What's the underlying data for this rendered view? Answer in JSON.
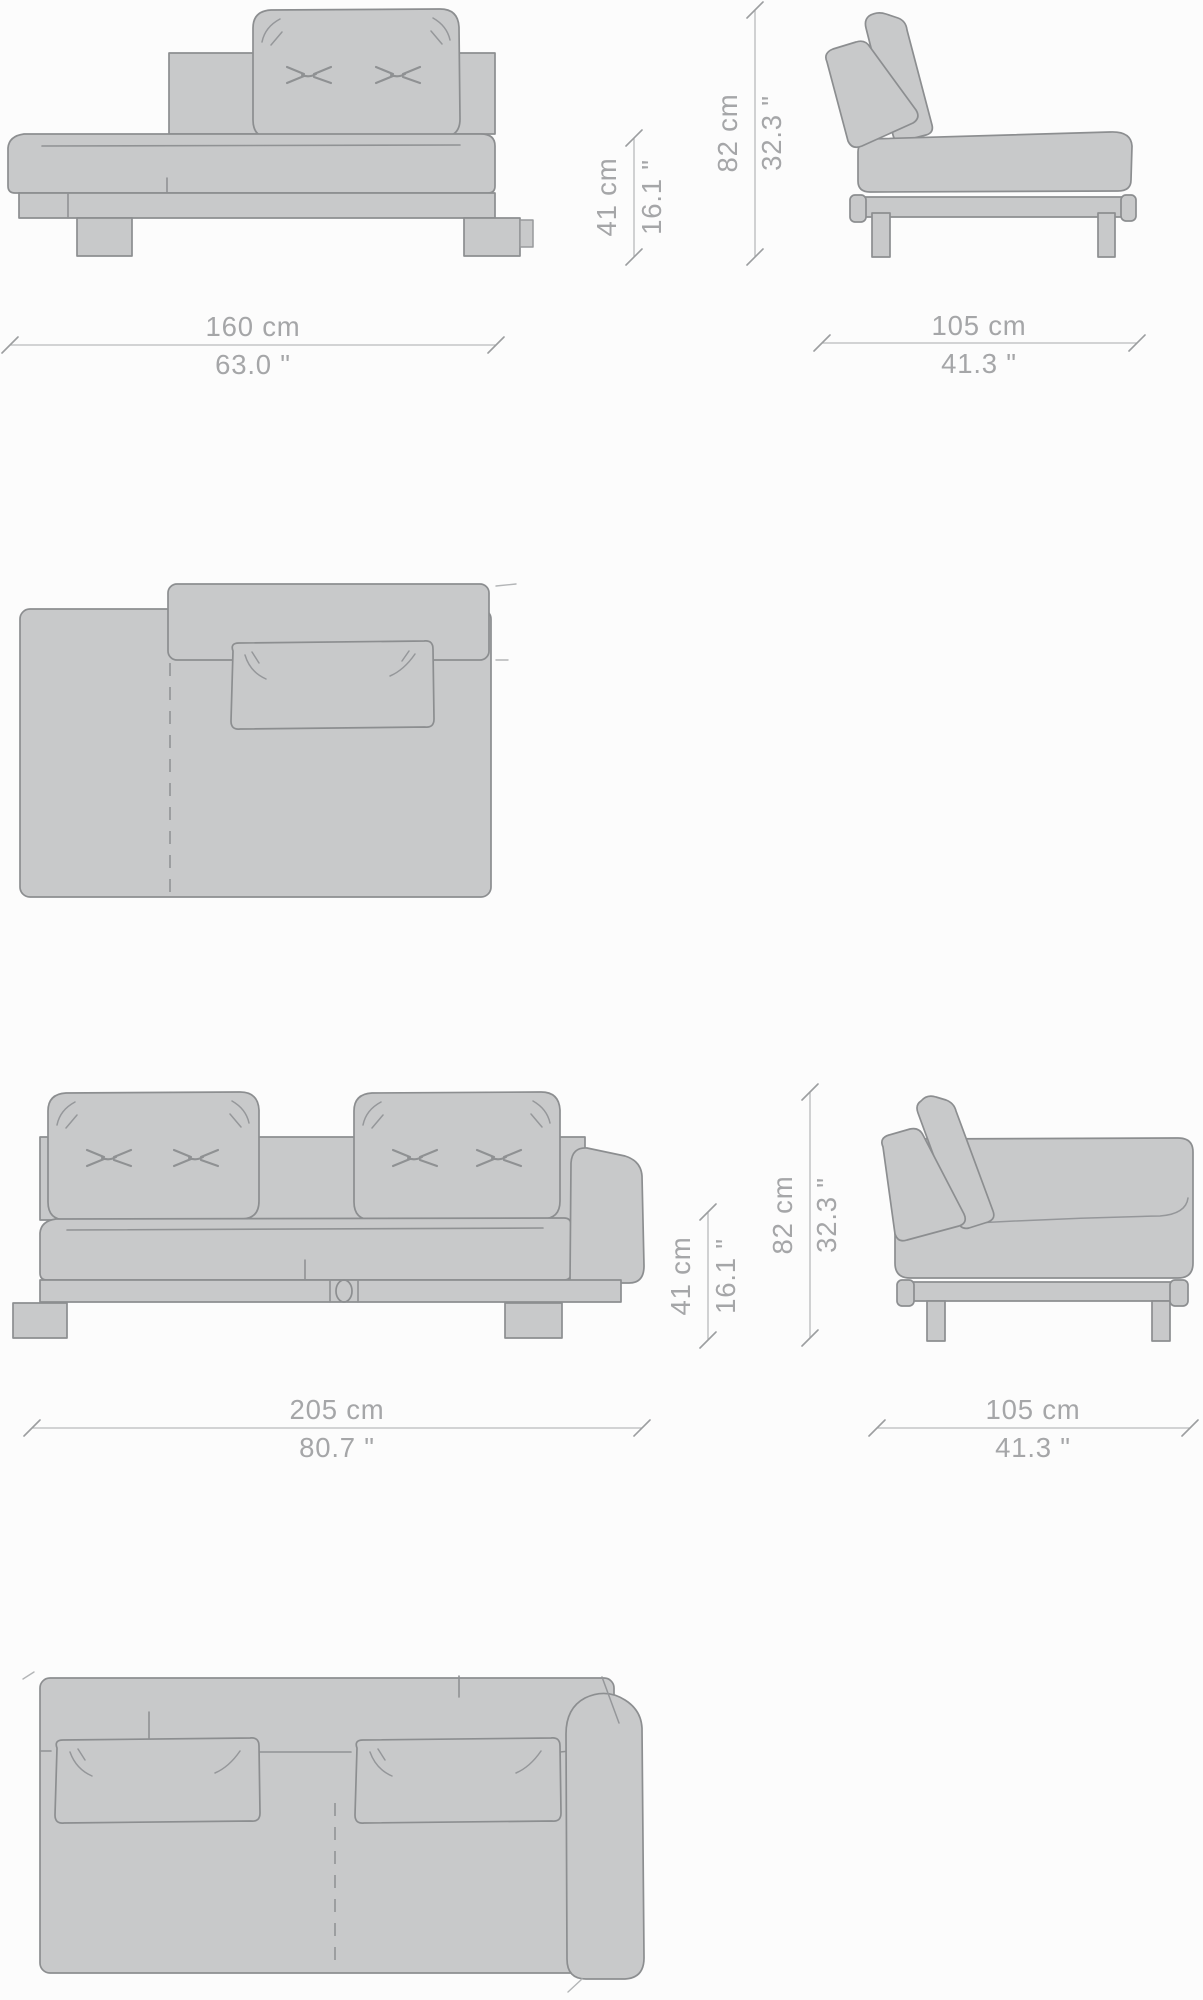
{
  "sheet": {
    "type": "furniture dimension drawing",
    "background": "#fcfcfc"
  },
  "styles": {
    "furniture_fill": "#c8c9ca",
    "furniture_outline": "#8c8e90",
    "dimension_line_color": "#b9babc",
    "dimension_text_color": "#a5a6a8"
  },
  "module": {
    "width_cm": "160 cm",
    "width_in": "63.0 \"",
    "seat_height_cm": "41 cm",
    "seat_height_in": "16.1 \"",
    "height_cm": "82 cm",
    "height_in": "32.3 \"",
    "depth_cm": "105 cm",
    "depth_in": "41.3 \""
  },
  "sofa": {
    "width_cm": "205 cm",
    "width_in": "80.7 \"",
    "seat_height_cm": "41 cm",
    "seat_height_in": "16.1 \"",
    "height_cm": "82 cm",
    "height_in": "32.3 \"",
    "depth_cm": "105 cm",
    "depth_in": "41.3 \""
  }
}
